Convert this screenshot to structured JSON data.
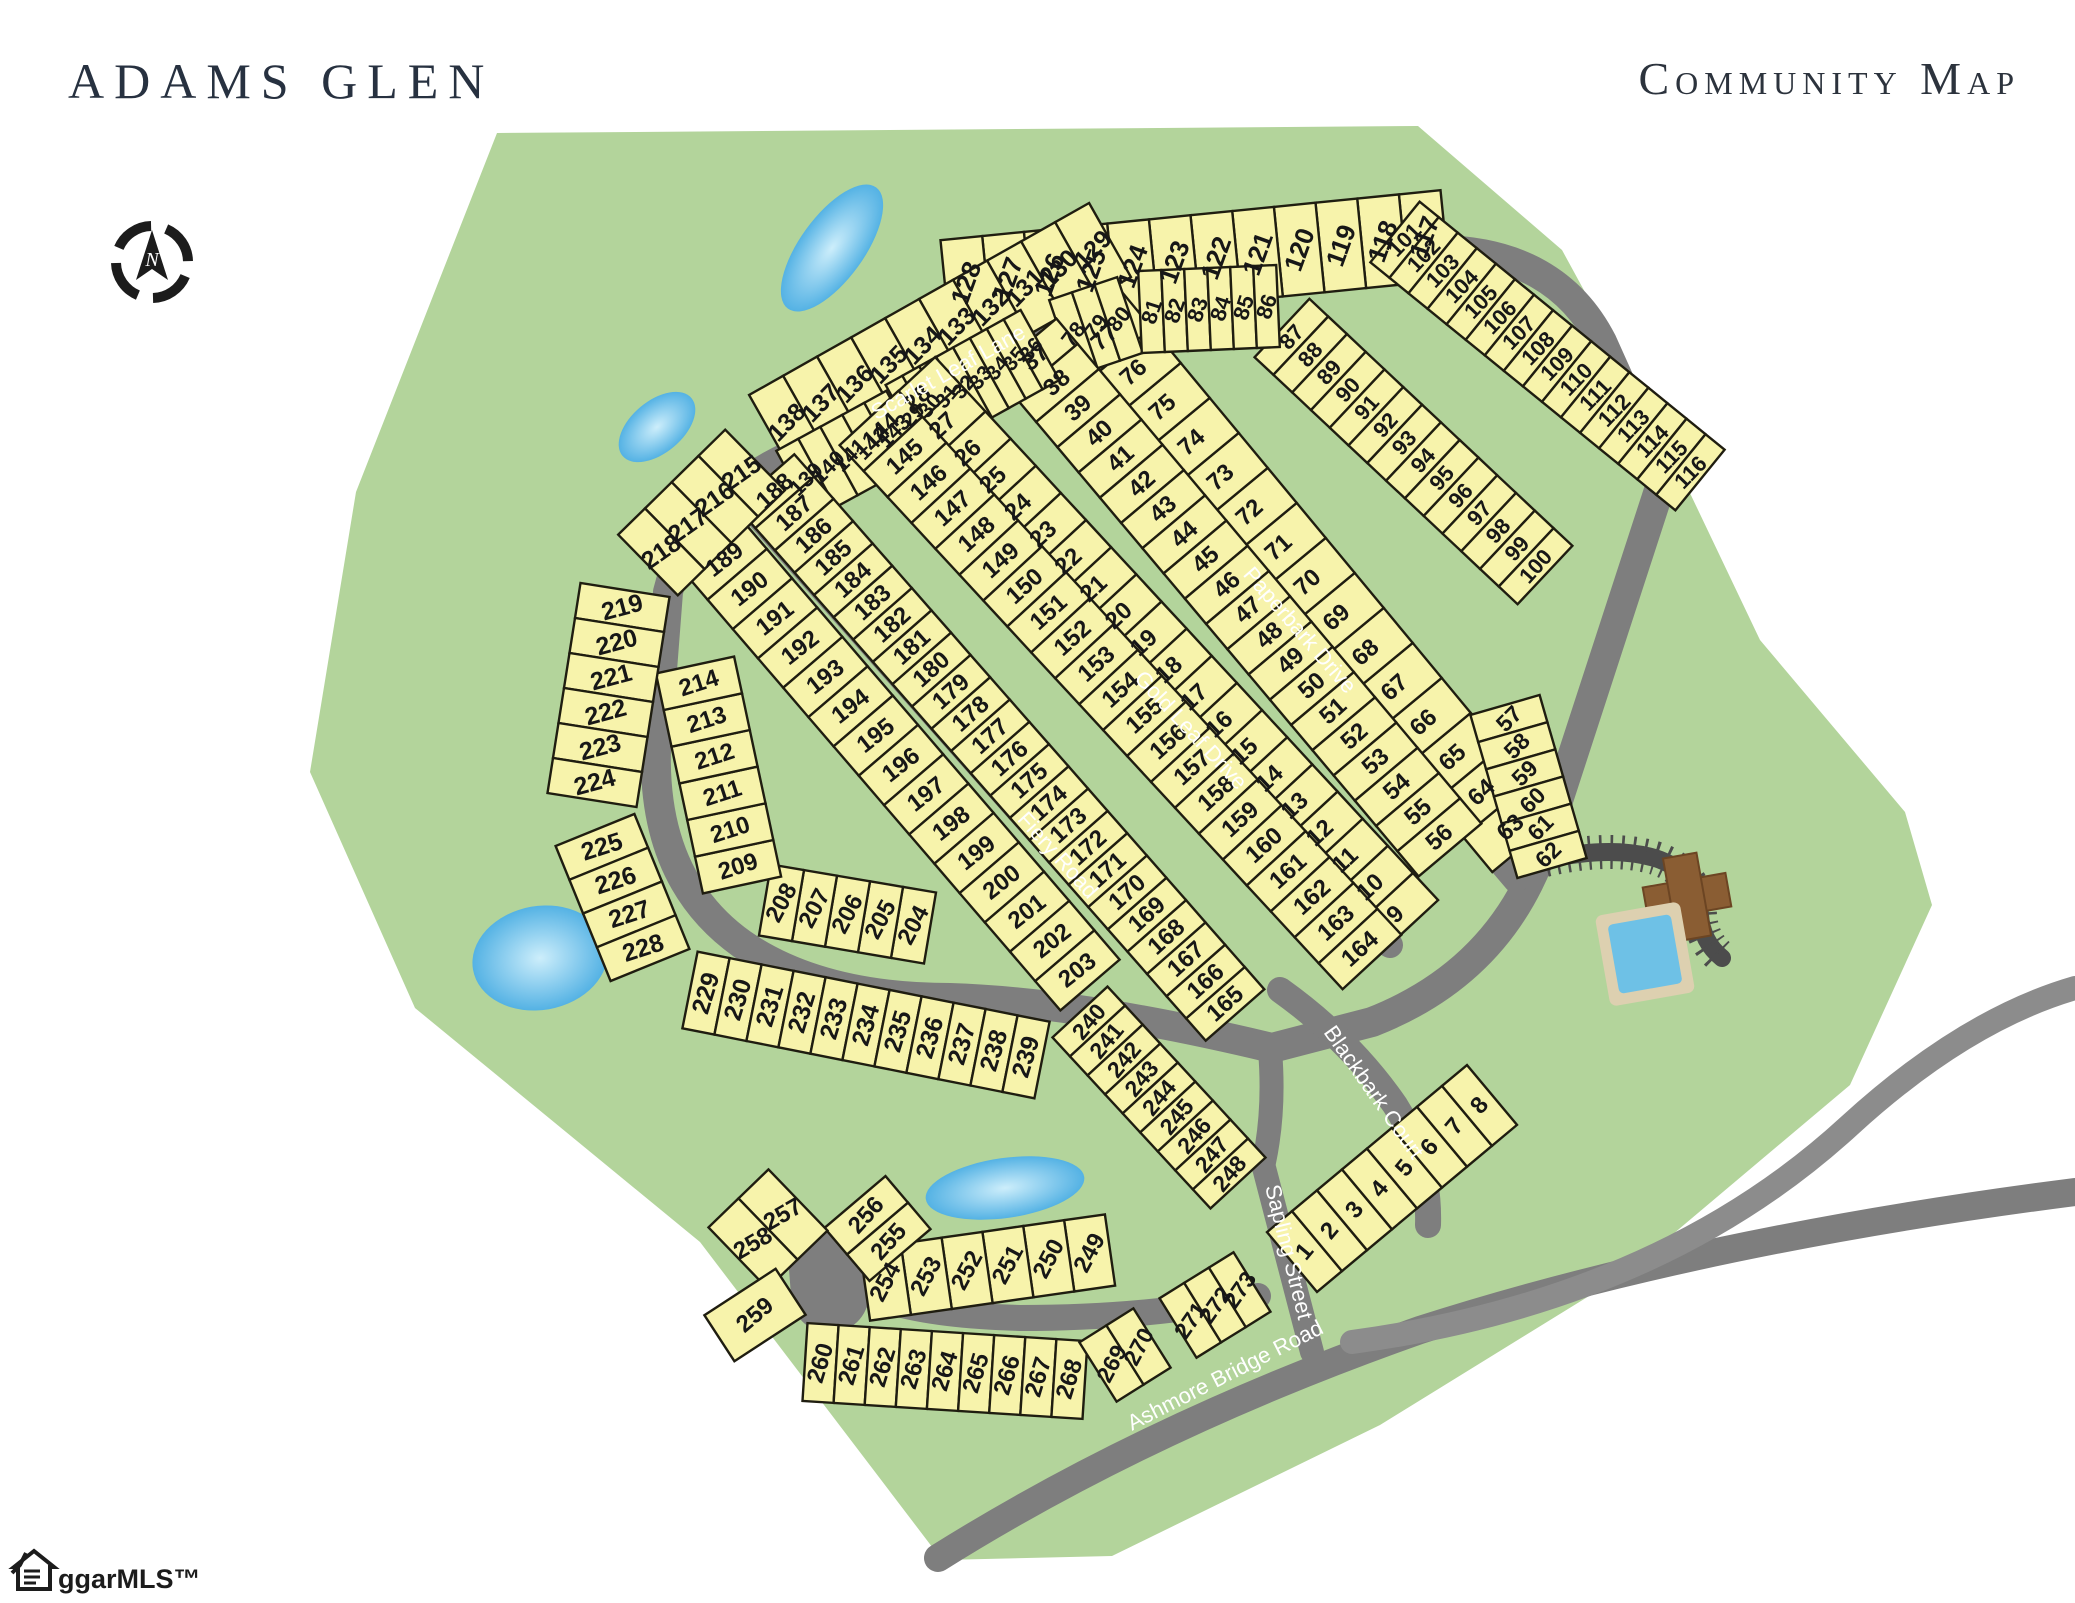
{
  "header": {
    "title": "ADAMS GLEN",
    "subtitle": "Community Map"
  },
  "watermark": {
    "label": "ggarMLS™"
  },
  "colors": {
    "greenspace": "#b3d49b",
    "lot_fill": "#f7f3ab",
    "lot_outline": "#1f1d10",
    "road": "#7e7e7e",
    "road_light": "#8c8c8c",
    "court_dark": "#4c4c4c",
    "pond_edge": "#54b2e4",
    "pond_center": "#cdeefb",
    "street_text": "#ffffff",
    "number_text": "#171717",
    "title_text": "#273140",
    "pool_water": "#6ec1e6",
    "pool_deck": "#ddd0b0",
    "clubhouse": "#8a5d33"
  },
  "map": {
    "green_path": "M 497,133 L 1418,126 L 1562,250 L 1658,426 L 1760,640 L 1905,812 L 1932,905 L 1850,1085 L 1628,1272 L 1380,1425 L 1112,1556 L 942,1560 L 700,1242 L 415,1008 L 310,772 L 356,492 Z",
    "ponds": [
      {
        "cx": 832,
        "cy": 248,
        "rx": 75,
        "ry": 32,
        "rot": -54
      },
      {
        "cx": 657,
        "cy": 427,
        "rx": 45,
        "ry": 26,
        "rot": -40
      },
      {
        "cx": 540,
        "cy": 958,
        "rx": 68,
        "ry": 52,
        "rot": -10
      },
      {
        "cx": 1005,
        "cy": 1188,
        "rx": 80,
        "ry": 30,
        "rot": -8
      }
    ],
    "roads": [
      {
        "name": "loop-road",
        "d": "M 1128,268 Q 1300,246 1440,250 Q 1556,252 1602,342 L 1663,478 L 1538,862 Q 1492,975 1372,1022 L 1272,1048 Q 1080,1002 950,998 Q 820,998 742,944 Q 652,880 656,748 L 668,592 Q 690,502 792,455 Z",
        "w": 30,
        "c": "road"
      },
      {
        "name": "fiery-road",
        "d": "M 740,495 L 1195,1010",
        "w": 26,
        "c": "road"
      },
      {
        "name": "gold-leaf-drive",
        "d": "M 887,401 L 1390,945",
        "w": 26,
        "c": "road"
      },
      {
        "name": "paperbark-drive",
        "d": "M 1038,318 L 1516,880",
        "w": 26,
        "c": "road"
      },
      {
        "name": "blackbark-court",
        "d": "M 1280,990 Q 1350,1040 1395,1105 Q 1430,1160 1428,1225",
        "w": 26,
        "c": "road"
      },
      {
        "name": "loop-sapling-connector",
        "d": "M 1270,1050 Q 1275,1110 1264,1162",
        "w": 24,
        "c": "road"
      },
      {
        "name": "sapling-street",
        "d": "M 1262,1160 L 1312,1352",
        "w": 24,
        "c": "road"
      },
      {
        "name": "culdesac-stem",
        "d": "M 852,1286 Q 900,1315 1020,1318 Q 1150,1318 1258,1296",
        "w": 26,
        "c": "road"
      },
      {
        "name": "culdesac-bulb",
        "d": "M 828,1268 L 830,1294",
        "w": 78,
        "c": "road"
      },
      {
        "name": "ashmore-bridge-road",
        "d": "M 938,1558 Q 1150,1425 1420,1330 Q 1700,1240 2075,1192",
        "w": 28,
        "c": "road"
      },
      {
        "name": "sweep-road",
        "d": "M 1352,1342 Q 1660,1300 1850,1125 Q 1965,1020 2075,988",
        "w": 24,
        "c": "road_light"
      },
      {
        "name": "amenity-court",
        "d": "M 1545,860 Q 1610,845 1655,858 Q 1698,872 1700,915 Q 1702,942 1722,958",
        "w": 18,
        "c": "court_dark",
        "ticks": true
      }
    ],
    "strips": [
      {
        "from": 117,
        "to": 128,
        "x1": 1445,
        "y1": 235,
        "x2": 945,
        "y2": 285,
        "d": 90,
        "rot": -70,
        "fs": 26
      },
      {
        "from": 101,
        "to": 116,
        "x1": 1395,
        "y1": 232,
        "x2": 1700,
        "y2": 480,
        "d": 78,
        "rot": -46,
        "fs": 22
      },
      {
        "from": 129,
        "to": 138,
        "x1": 1110,
        "y1": 240,
        "x2": 770,
        "y2": 432,
        "d": 85,
        "rot": -46,
        "fs": 25
      },
      {
        "from": 87,
        "to": 100,
        "x1": 1282,
        "y1": 328,
        "x2": 1545,
        "y2": 575,
        "d": 80,
        "rot": -48,
        "fs": 22
      },
      {
        "from": 63,
        "to": 77,
        "x1": 1525,
        "y1": 845,
        "x2": 1090,
        "y2": 320,
        "d": 85,
        "rot": -42,
        "fs": 24
      },
      {
        "from": 78,
        "to": 80,
        "x1": 1062,
        "y1": 338,
        "x2": 1130,
        "y2": 315,
        "d": 80,
        "rot": -52,
        "fs": 22
      },
      {
        "from": 81,
        "to": 86,
        "x1": 1140,
        "y1": 312,
        "x2": 1278,
        "y2": 306,
        "d": 82,
        "rot": -72,
        "fs": 22
      },
      {
        "from": 37,
        "to": 56,
        "x1": 1025,
        "y1": 345,
        "x2": 1450,
        "y2": 850,
        "d": 82,
        "rot": -42,
        "fs": 24
      },
      {
        "from": 57,
        "to": 62,
        "x1": 1505,
        "y1": 705,
        "x2": 1552,
        "y2": 868,
        "d": 72,
        "rot": -45,
        "fs": 23
      },
      {
        "from": 29,
        "to": 36,
        "x1": 905,
        "y1": 420,
        "x2": 1040,
        "y2": 345,
        "d": 80,
        "rot": -50,
        "fs": 21
      },
      {
        "from": 9,
        "to": 28,
        "x1": 1408,
        "y1": 928,
        "x2": 905,
        "y2": 385,
        "d": 82,
        "rot": -43,
        "fs": 24
      },
      {
        "from": 1,
        "to": 8,
        "x1": 1292,
        "y1": 1262,
        "x2": 1492,
        "y2": 1095,
        "d": 78,
        "rot": -50,
        "fs": 24
      },
      {
        "from": 139,
        "to": 143,
        "x1": 795,
        "y1": 485,
        "x2": 905,
        "y2": 425,
        "d": 78,
        "rot": -45,
        "fs": 22
      },
      {
        "from": 144,
        "to": 164,
        "x1": 869,
        "y1": 418,
        "x2": 1372,
        "y2": 962,
        "d": 80,
        "rot": -42,
        "fs": 24
      },
      {
        "from": 165,
        "to": 188,
        "x1": 1235,
        "y1": 1015,
        "x2": 765,
        "y2": 480,
        "d": 78,
        "rot": -42,
        "fs": 24
      },
      {
        "from": 189,
        "to": 203,
        "x1": 712,
        "y1": 545,
        "x2": 1090,
        "y2": 985,
        "d": 78,
        "rot": -38,
        "fs": 24
      },
      {
        "from": 204,
        "to": 208,
        "x1": 930,
        "y1": 928,
        "x2": 765,
        "y2": 900,
        "d": 72,
        "rot": -62,
        "fs": 24
      },
      {
        "from": 209,
        "to": 214,
        "x1": 742,
        "y1": 885,
        "x2": 695,
        "y2": 665,
        "d": 80,
        "rot": -18,
        "fs": 24
      },
      {
        "from": 215,
        "to": 218,
        "x1": 755,
        "y1": 460,
        "x2": 648,
        "y2": 565,
        "d": 85,
        "rot": -35,
        "fs": 25
      },
      {
        "from": 219,
        "to": 224,
        "x1": 625,
        "y1": 590,
        "x2": 592,
        "y2": 800,
        "d": 90,
        "rot": -15,
        "fs": 25
      },
      {
        "from": 225,
        "to": 228,
        "x1": 595,
        "y1": 830,
        "x2": 650,
        "y2": 965,
        "d": 85,
        "rot": -18,
        "fs": 25
      },
      {
        "from": 229,
        "to": 239,
        "x1": 690,
        "y1": 990,
        "x2": 1042,
        "y2": 1060,
        "d": 78,
        "rot": -73,
        "fs": 25
      },
      {
        "from": 240,
        "to": 248,
        "x1": 1080,
        "y1": 1012,
        "x2": 1238,
        "y2": 1183,
        "d": 75,
        "rot": -50,
        "fs": 23
      },
      {
        "from": 249,
        "to": 254,
        "x1": 1110,
        "y1": 1250,
        "x2": 865,
        "y2": 1285,
        "d": 72,
        "rot": -62,
        "fs": 24
      },
      {
        "from": 255,
        "to": 256,
        "x1": 900,
        "y1": 1255,
        "x2": 855,
        "y2": 1202,
        "d": 80,
        "rot": -48,
        "fs": 24
      },
      {
        "from": 257,
        "to": 258,
        "x1": 798,
        "y1": 1200,
        "x2": 738,
        "y2": 1258,
        "d": 85,
        "rot": -30,
        "fs": 24
      },
      {
        "from": 259,
        "to": 259,
        "x1": 740,
        "y1": 1292,
        "x2": 770,
        "y2": 1338,
        "d": 85,
        "rot": -40,
        "fs": 24
      },
      {
        "from": 260,
        "to": 268,
        "x1": 805,
        "y1": 1362,
        "x2": 1085,
        "y2": 1380,
        "d": 78,
        "rot": -73,
        "fs": 24
      },
      {
        "from": 269,
        "to": 270,
        "x1": 1098,
        "y1": 1372,
        "x2": 1152,
        "y2": 1338,
        "d": 70,
        "rot": -62,
        "fs": 23
      },
      {
        "from": 271,
        "to": 273,
        "x1": 1178,
        "y1": 1328,
        "x2": 1252,
        "y2": 1282,
        "d": 70,
        "rot": -55,
        "fs": 23
      }
    ],
    "street_labels": [
      {
        "text": "Scarlet Leaf Lane",
        "x": 948,
        "y": 372,
        "rot": -29
      },
      {
        "text": "Paperbark Drive",
        "x": 1300,
        "y": 630,
        "rot": 49
      },
      {
        "text": "Gold Leaf Drive",
        "x": 1191,
        "y": 730,
        "rot": 47
      },
      {
        "text": "Fiery Road",
        "x": 1058,
        "y": 855,
        "rot": 48
      },
      {
        "text": "Blackbark Court",
        "x": 1374,
        "y": 1092,
        "rot": 55
      },
      {
        "text": "Sapling Street",
        "x": 1289,
        "y": 1252,
        "rot": 76
      },
      {
        "text": "Ashmore Bridge Road",
        "x": 1225,
        "y": 1375,
        "rot": -27
      }
    ],
    "amenity": {
      "pool": {
        "x": 1602,
        "y": 908,
        "w": 86,
        "h": 92,
        "rot": -10
      },
      "clubhouse": {
        "cx": 1687,
        "cy": 897,
        "rot": -10
      }
    }
  }
}
